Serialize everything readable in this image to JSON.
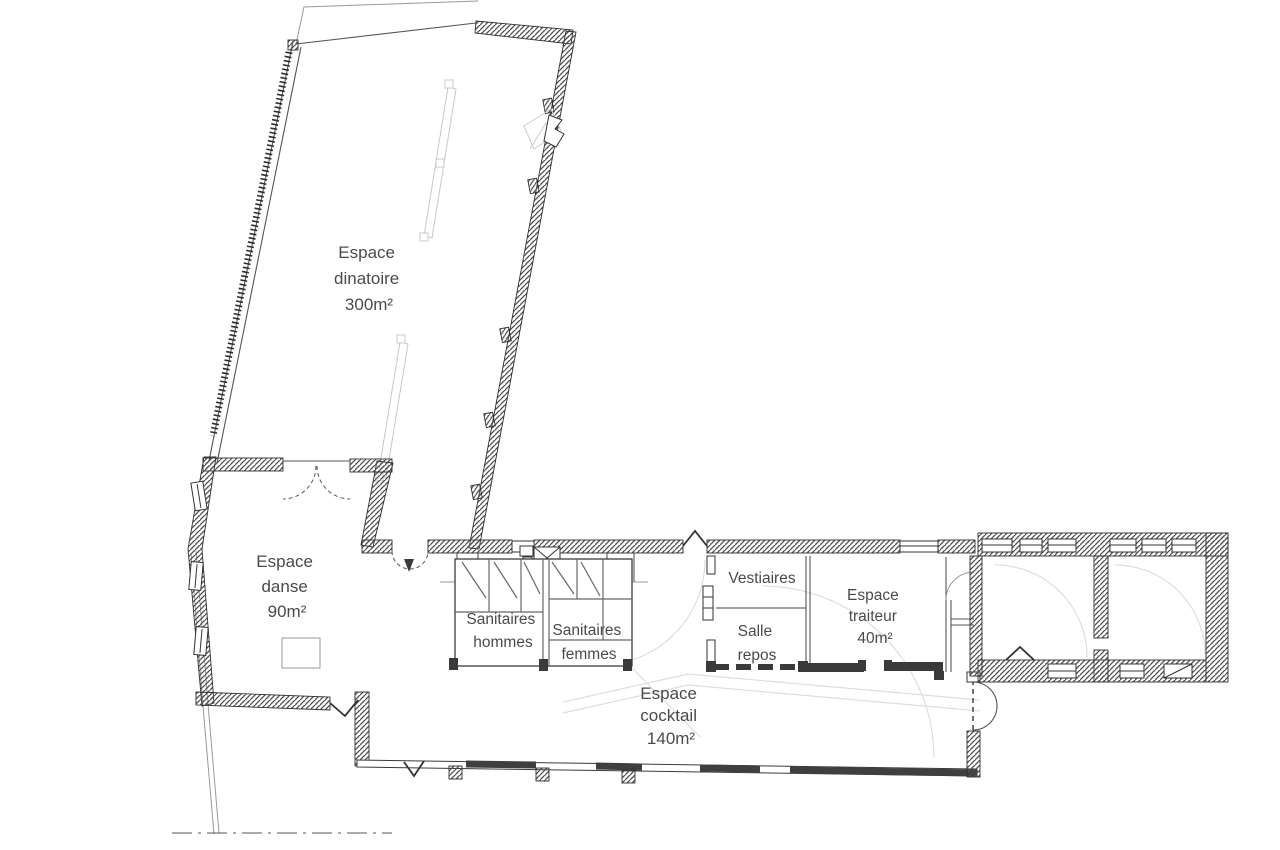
{
  "rooms": {
    "dinatoire": {
      "line1": "Espace",
      "line2": "dinatoire",
      "area": "300m²"
    },
    "danse": {
      "line1": "Espace",
      "line2": "danse",
      "area": "90m²"
    },
    "sanitaires_hommes": {
      "line1": "Sanitaires",
      "line2": "hommes"
    },
    "sanitaires_femmes": {
      "line1": "Sanitaires",
      "line2": "femmes"
    },
    "vestiaires": {
      "line1": "Vestiaires"
    },
    "salle_repos": {
      "line1": "Salle",
      "line2": "repos"
    },
    "traiteur": {
      "line1": "Espace",
      "line2": "traiteur",
      "area": "40m²"
    },
    "cocktail": {
      "line1": "Espace",
      "line2": "cocktail",
      "area": "140m²"
    }
  },
  "colors": {
    "ink": "#3a3a3a",
    "wall_hatch": "#4e4e4e",
    "text": "#4a4a4a",
    "faint": "#dedede",
    "background": "#ffffff"
  }
}
